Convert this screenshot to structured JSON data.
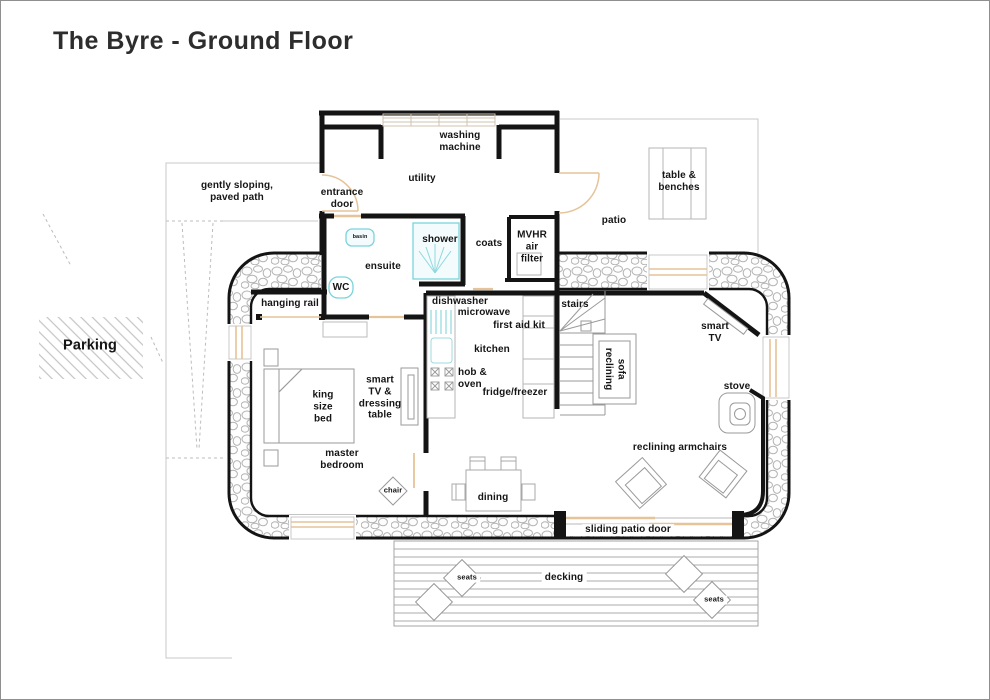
{
  "title": "The Byre - Ground Floor",
  "colors": {
    "wall": "#141414",
    "window_door_tan": "#e6c398",
    "fixture_cyan": "#7ad4dc",
    "furniture_gray": "#9a9a9a",
    "site_gray": "#c9c9c9"
  },
  "site": {
    "paved_path_label": "gently sloping,\npaved path",
    "parking_label": "Parking",
    "patio_label": "patio",
    "table_benches_label": "table &\nbenches",
    "decking_label": "decking",
    "seats_left_label": "seats",
    "seats_right_label": "seats"
  },
  "utility": {
    "room_label": "utility",
    "washing_machine_label": "washing\nmachine",
    "entrance_door_label": "entrance\ndoor"
  },
  "hall": {
    "coats_label": "coats",
    "mvhr_label": "MVHR\nair\nfilter",
    "stairs_label": "stairs"
  },
  "ensuite": {
    "room_label": "ensuite",
    "basin_label": "basin",
    "wc_label": "WC",
    "shower_label": "shower"
  },
  "bedroom": {
    "room_label": "master\nbedroom",
    "bed_label": "king\nsize\nbed",
    "hanging_rail_label": "hanging rail",
    "tv_dressing_label": "smart\nTV &\ndressing\ntable",
    "chair_label": "chair"
  },
  "kitchen": {
    "room_label": "kitchen",
    "dishwasher_label": "dishwasher",
    "microwave_label": "microwave",
    "first_aid_label": "first aid kit",
    "hob_oven_label": "hob &\noven",
    "fridge_label": "fridge/freezer"
  },
  "living": {
    "sofa_label": "reclining\nsofa",
    "tv_label": "smart\nTV",
    "stove_label": "stove",
    "armchairs_label": "reclining armchairs",
    "dining_label": "dining",
    "sliding_door_label": "sliding patio door"
  }
}
